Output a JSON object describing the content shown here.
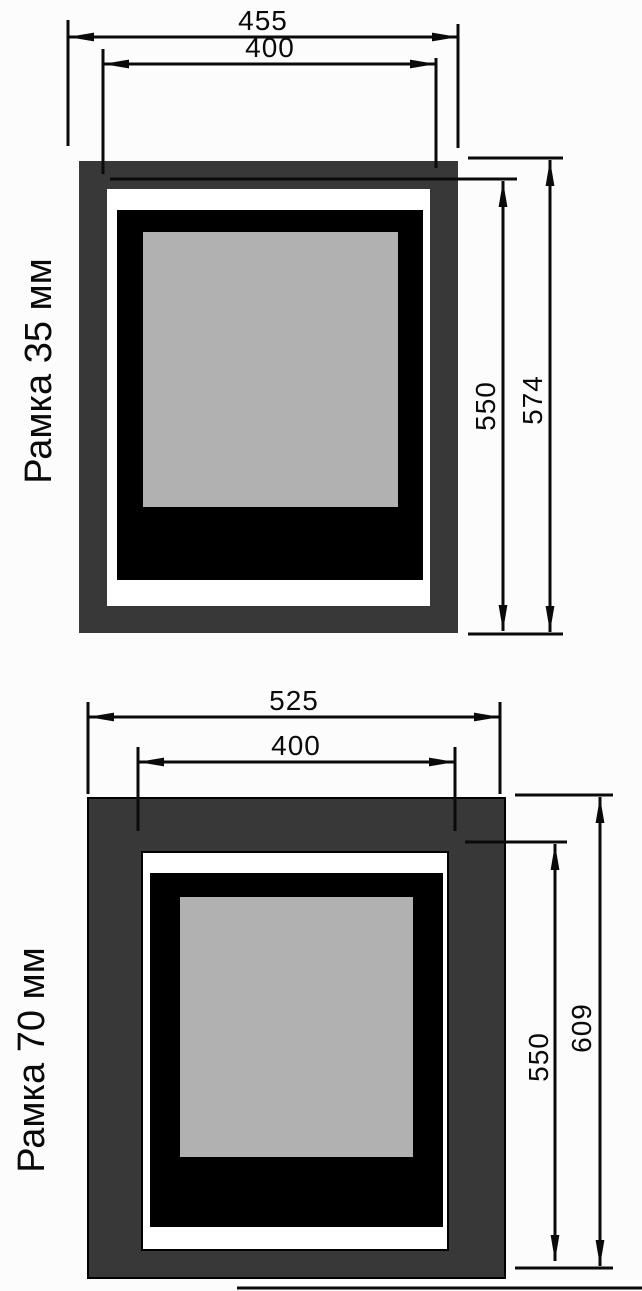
{
  "colors": {
    "frame_gray": "#383838",
    "mat_white": "#ffffff",
    "mount_black": "#000000",
    "photo_gray": "#b1b1b1",
    "line_black": "#0a0a0a",
    "background": "#fcfcfc"
  },
  "diagrams": [
    {
      "label": "Рамка 35 мм",
      "dimensions": {
        "outer_width": "455",
        "opening_width": "400",
        "opening_height": "550",
        "outer_height": "574"
      }
    },
    {
      "label": "Рамка 70 мм",
      "dimensions": {
        "outer_width": "525",
        "opening_width": "400",
        "opening_height": "550",
        "outer_height": "609"
      }
    }
  ]
}
